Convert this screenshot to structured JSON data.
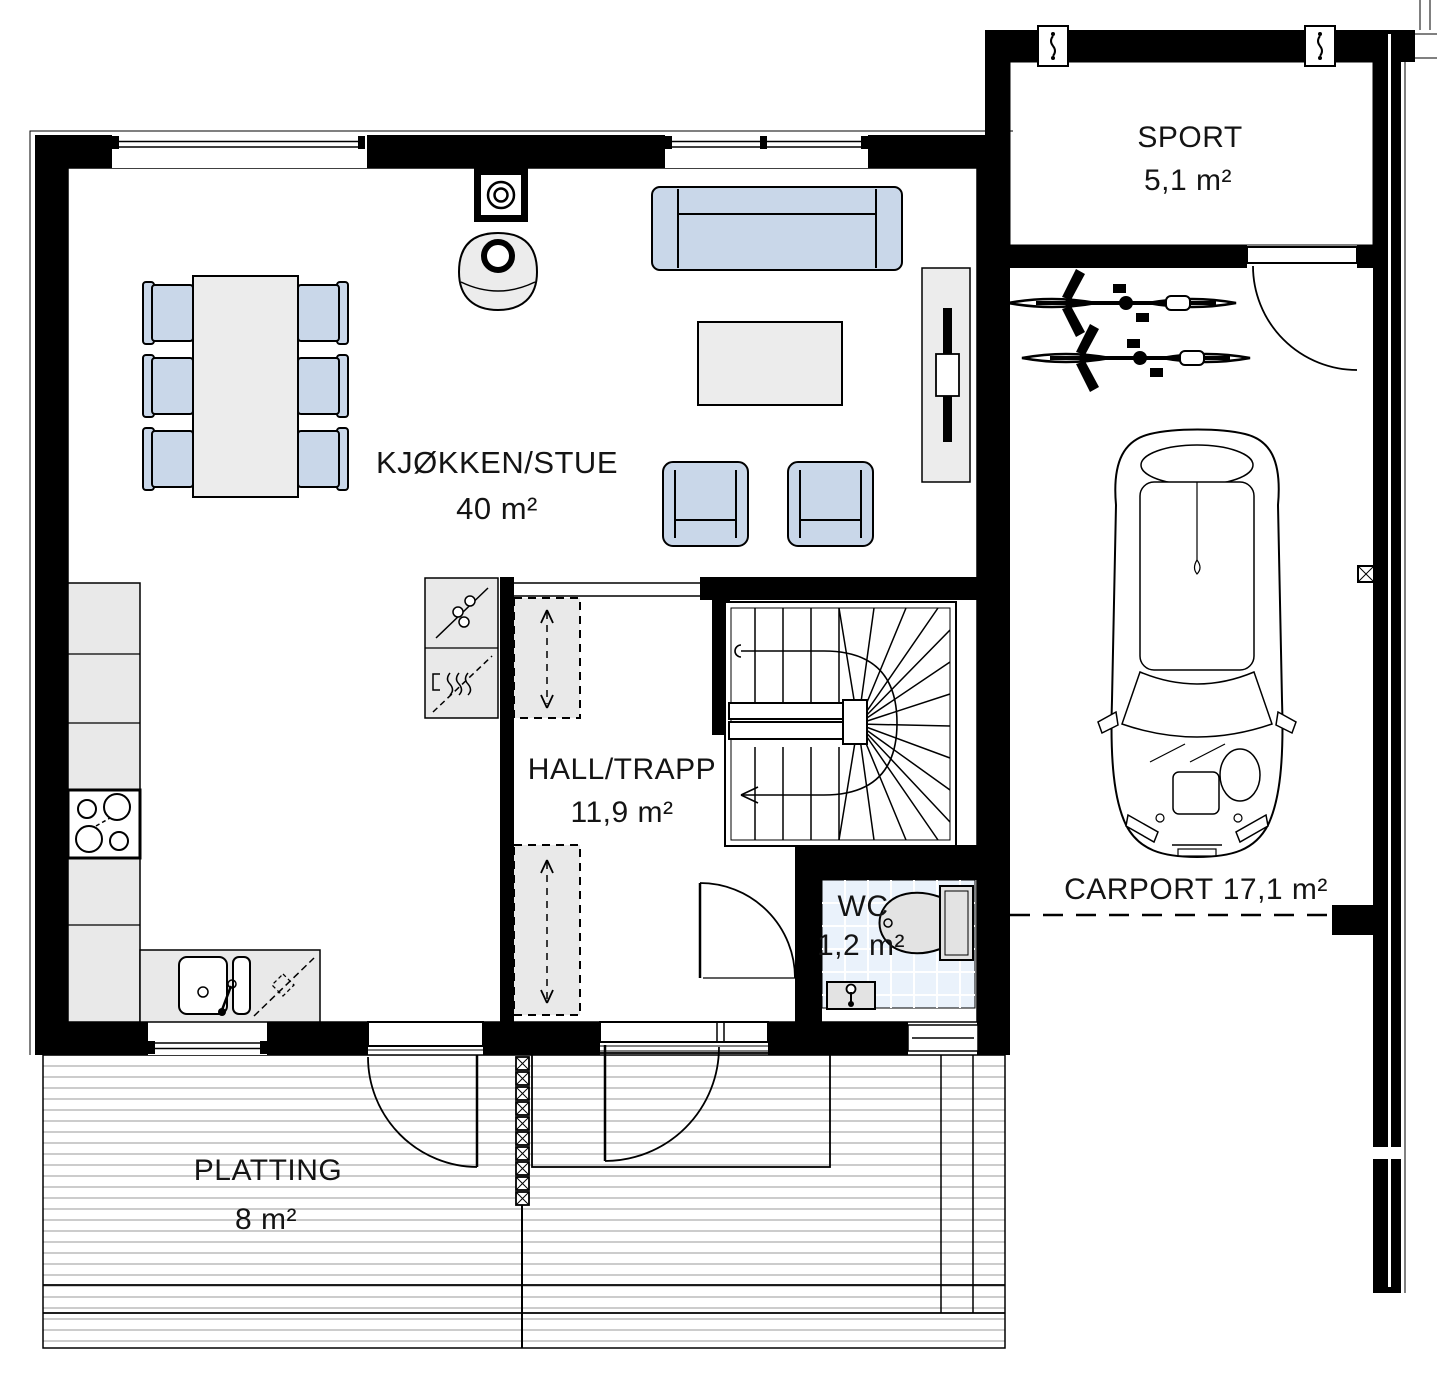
{
  "document_type": "architectural-floor-plan",
  "rooms": {
    "kitchen_living": {
      "name": "KJØKKEN/STUE",
      "area": "40 m²"
    },
    "hall": {
      "name": "HALL/TRAPP",
      "area": "11,9 m²"
    },
    "wc": {
      "name": "WC",
      "area": "1,2 m²"
    },
    "sport": {
      "name": "SPORT",
      "area": "5,1 m²"
    },
    "carport": {
      "name": "CARPORT",
      "area": "17,1 m²"
    },
    "platting": {
      "name": "PLATTING",
      "area": "8 m²"
    }
  },
  "fixtures": [
    "dining-table",
    "dining-chairs",
    "wood-stove",
    "chimney",
    "sofa",
    "coffee-table",
    "armchairs",
    "tv-bench",
    "kitchen-counter",
    "cooktop",
    "kitchen-sink",
    "dishwasher",
    "fridge-oven-cabinet",
    "wardrobes",
    "winder-staircase",
    "toilet",
    "wc-sink",
    "entrance-door",
    "balcony-door",
    "wc-door",
    "sport-door",
    "bicycles",
    "car",
    "deck-divider-posts"
  ],
  "colors": {
    "wall": "#000000",
    "furniture_blue": "#c9d7e9",
    "furniture_gray": "#ececec",
    "wc_tile": "#eaf2fb",
    "deck_line": "#bcbcbc",
    "line": "#000000",
    "background": "#ffffff"
  }
}
